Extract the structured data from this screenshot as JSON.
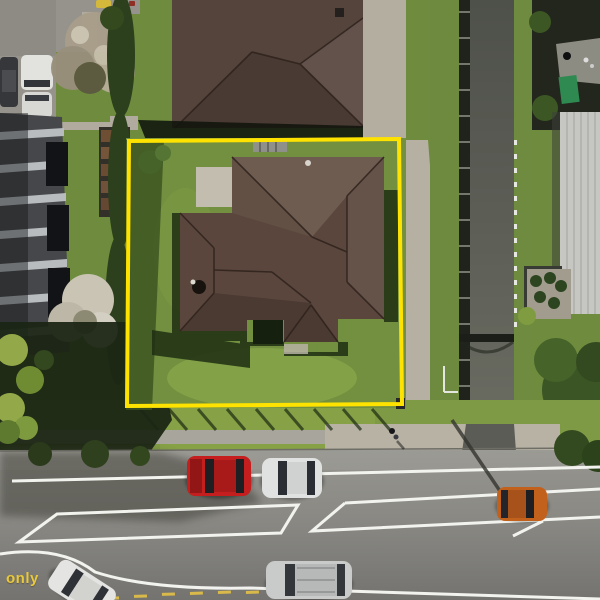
{
  "photo": {
    "kind": "aerial-drone-photo",
    "subject": "single-storey house on fenced section with highlighted boundary, street with parked cars below"
  },
  "watermark": {
    "text": "only",
    "color": "#e9c93c"
  },
  "boundary": {
    "color": "#ffe300"
  },
  "palette": {
    "lawn": "#72903f",
    "lawn_light": "#8aa74b",
    "roof_main": "#5a463c",
    "roof_neighbor": "#55443c",
    "road": "#8a8984",
    "concrete": "#b5b0a2",
    "footpath": "#a8a69c",
    "alley": "#5b5d55",
    "shadow": "#1c2514",
    "marking_white": "#f2f2ee",
    "marking_yellow": "#d8b94a"
  },
  "vehicles": {
    "red_car": {
      "color": "#c41e1e"
    },
    "white_car": {
      "color": "#e0e2e1"
    },
    "orange_car": {
      "color": "#c2611c"
    },
    "silver_suv": {
      "color": "#c9cbca"
    },
    "white_car_corner": {
      "color": "#e4e4e2"
    },
    "dark_car": {
      "color": "#35373a"
    },
    "white_van": {
      "color": "#e2e2df"
    },
    "white_hatch": {
      "color": "#d8d8d4"
    },
    "yellow_car": {
      "color": "#d4b83c"
    }
  }
}
